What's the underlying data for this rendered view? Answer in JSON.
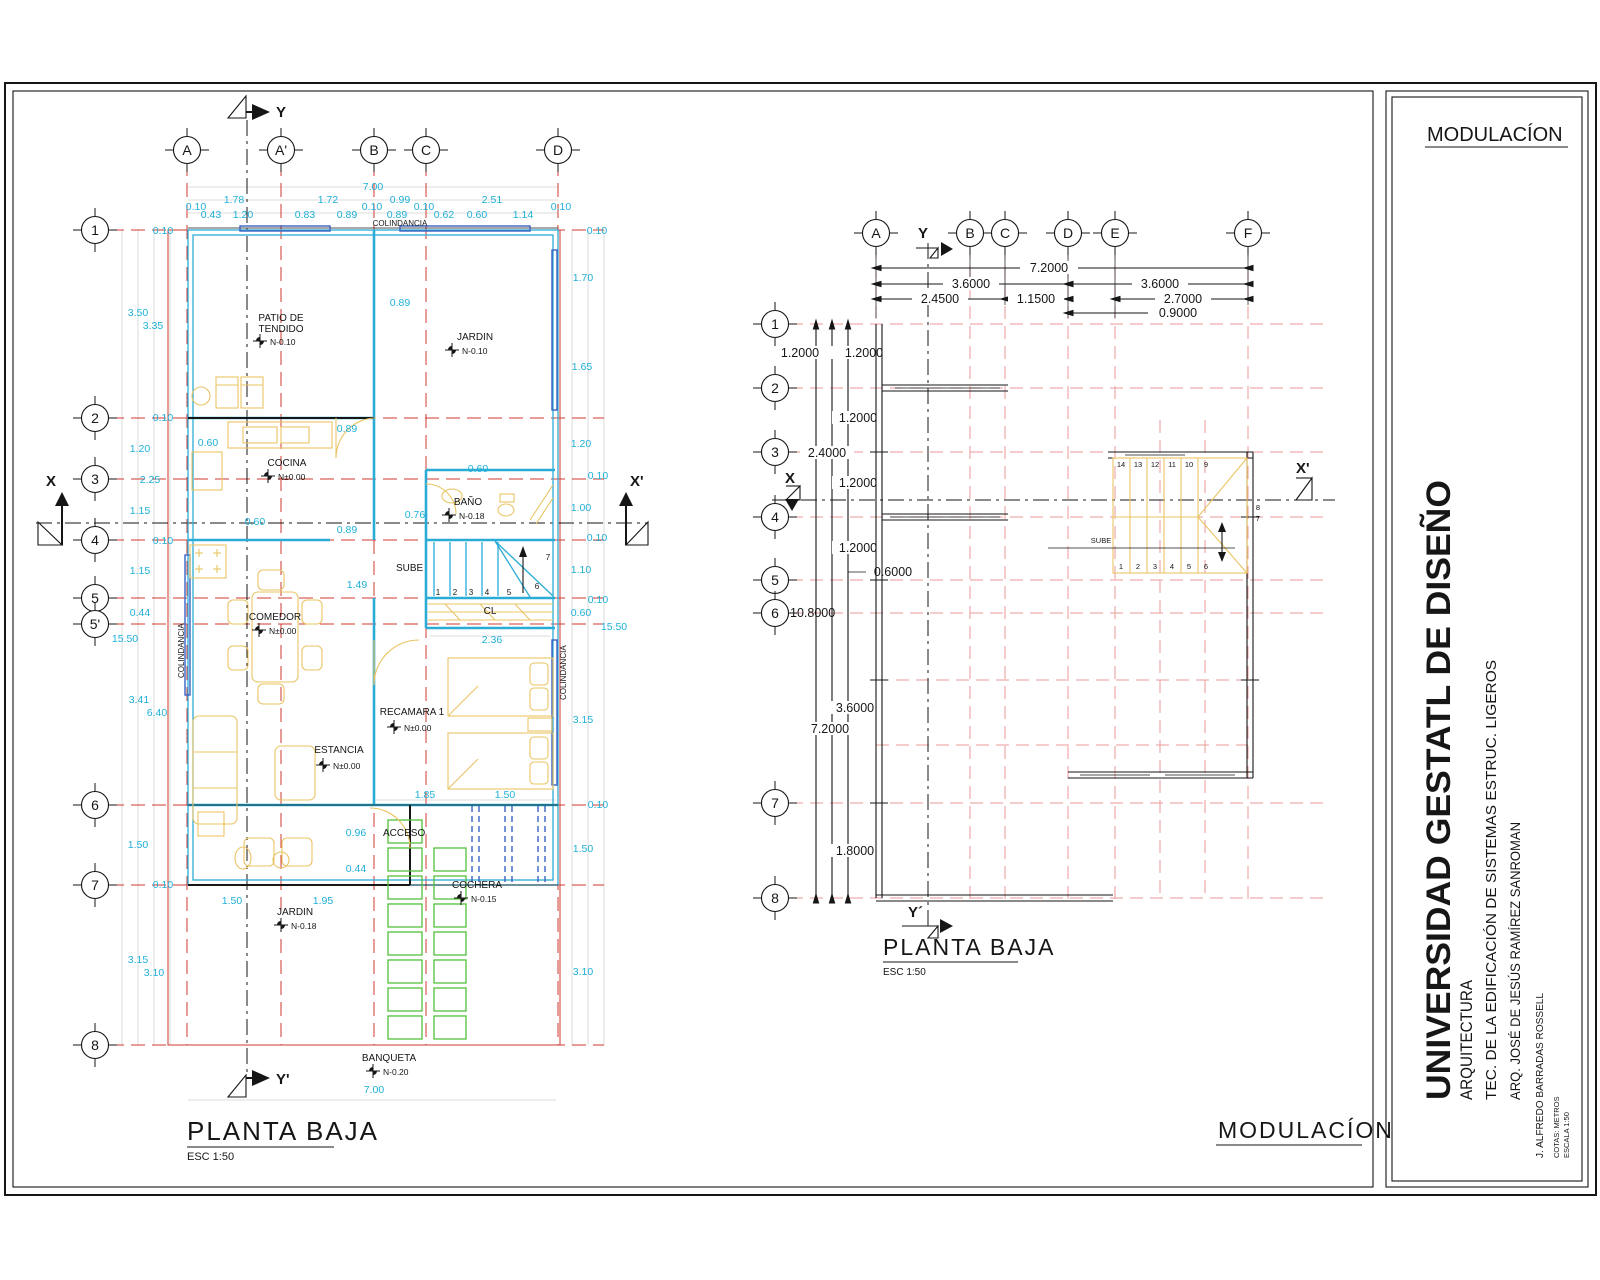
{
  "colors": {
    "dim_cyan": "#1fb0d8",
    "grid_red": "#cf3a30",
    "grid_pink": "#e89a9a",
    "wall_cyan": "#2bacd6",
    "window_blue": "#3a62c4",
    "furniture_yellow": "#eac463",
    "paver_green": "#52bf3a",
    "ink_black": "#161616"
  },
  "tb": {
    "heading": "MODULACÍON",
    "university": "UNIVERSIDAD GESTATL DE DISEÑO",
    "faculty": "ARQUITECTURA",
    "course": "TEC. DE LA EDIFICACIÓN DE SISTEMAS ESTRUC. LIGEROS",
    "professor": "ARQ. JOSÉ DE JESÚS RAMÍREZ SANROMAN",
    "author": "J. ALFREDO BARRADAS ROSSELL",
    "units_note": "COTAS: METROS",
    "scale_note": "ESCALA 1:50"
  },
  "lp": {
    "title": "PLANTA BAJA",
    "scale": "ESC 1:50",
    "cols": [
      "A",
      "A'",
      "B",
      "C",
      "D"
    ],
    "rows": [
      "1",
      "2",
      "3",
      "4",
      "5",
      "5'",
      "6",
      "7",
      "8"
    ],
    "axes": {
      "x": "X",
      "x2": "X'",
      "y": "Y",
      "y2": "Y'"
    },
    "colindancia": "COLINDANCIA",
    "top_total": "7.00",
    "top_major": [
      "1.78",
      "1.72",
      "0.99",
      "2.51"
    ],
    "top_minor": [
      "0.10",
      "0.43",
      "1.20",
      "0.83",
      "0.89",
      "0.10",
      "0.89",
      "0.10",
      "0.62",
      "0.60",
      "1.14",
      "0.10"
    ],
    "left": [
      "0.10",
      "3.50",
      "3.35",
      "0.10",
      "1.20",
      "2.25",
      "1.15",
      "0.10",
      "1.15",
      "0.44",
      "15.50",
      "3.41",
      "6.40",
      "1.50",
      "0.10",
      "3.15",
      "3.10"
    ],
    "right": [
      "0.10",
      "1.70",
      "1.65",
      "1.20",
      "0.10",
      "1.00",
      "0.10",
      "1.10",
      "0.10",
      "0.60",
      "15.50",
      "3.15",
      "0.10",
      "1.50",
      "3.10"
    ],
    "inner": [
      "0.89",
      "0.60",
      "0.89",
      "0.60",
      "0.89",
      "0.60",
      "0.76",
      "1.49",
      "2.36",
      "1.85",
      "1.50",
      "0.96",
      "0.44",
      "1.50",
      "1.95"
    ],
    "bottom_total": "7.00",
    "rooms": {
      "patio1": "PATIO DE",
      "patio2": "TENDIDO",
      "patio_lvl": "N-0.10",
      "jardin": "JARDIN",
      "jardin_lvl": "N-0.10",
      "cocina": "COCINA",
      "cocina_lvl": "N±0.00",
      "bano": "BAÑO",
      "bano_lvl": "N-0.18",
      "sube": "SUBE",
      "comedor": "COMEDOR",
      "comedor_lvl": "N±0.00",
      "cl": "CL",
      "recamara": "RECAMARA 1",
      "recamara_lvl": "N±0.00",
      "estancia": "ESTANCIA",
      "estancia_lvl": "N±0.00",
      "acceso": "ACCESO",
      "cochera": "COCHERA",
      "cochera_lvl": "N-0.15",
      "jardin2": "JARDIN",
      "jardin2_lvl": "N-0.18",
      "banqueta": "BANQUETA",
      "banqueta_lvl": "N-0.20"
    },
    "stairs": [
      "1",
      "2",
      "3",
      "4",
      "5",
      "6",
      "7"
    ]
  },
  "rp": {
    "title": "PLANTA BAJA",
    "scale": "ESC 1:50",
    "heading": "MODULACÍON",
    "cols": [
      "A",
      "B",
      "C",
      "D",
      "E",
      "F"
    ],
    "rows": [
      "1",
      "2",
      "3",
      "4",
      "5",
      "6",
      "7",
      "8"
    ],
    "axes": {
      "x": "X",
      "x2": "X'",
      "y": "Y",
      "y2": "Y´"
    },
    "h": [
      "7.2000",
      "3.6000",
      "3.6000",
      "2.4500",
      "1.1500",
      "2.7000",
      "0.9000"
    ],
    "v": [
      "1.2000",
      "1.2000",
      "1.2000",
      "2.4000",
      "1.2000",
      "1.2000",
      "0.6000",
      "10.8000",
      "3.6000",
      "7.2000",
      "1.8000"
    ],
    "sube": "SUBE",
    "st_top": [
      "14",
      "13",
      "12",
      "11",
      "10",
      "9"
    ],
    "st_bot": [
      "1",
      "2",
      "3",
      "4",
      "5",
      "6"
    ],
    "st_mid": [
      "8",
      "7"
    ]
  }
}
